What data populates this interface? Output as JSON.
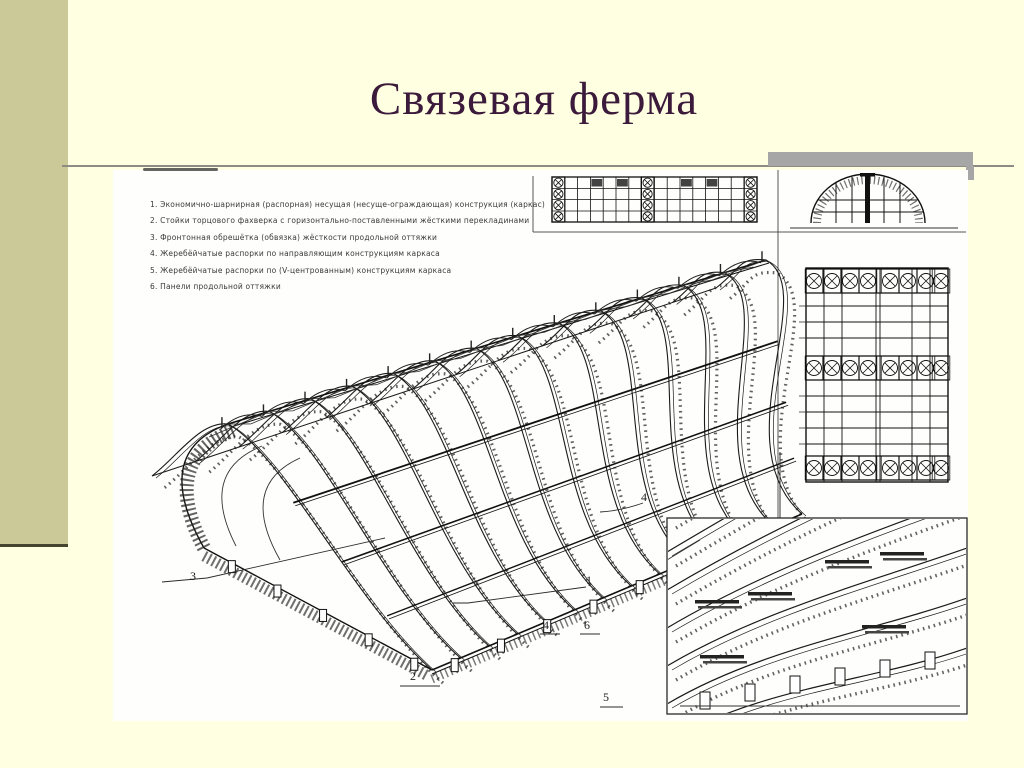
{
  "slide": {
    "title": "Связевая ферма"
  },
  "figure": {
    "legend": {
      "items": [
        "1.  Экономично-шарнирная (распорная) несущая (несуще-ограждающая) конструкция (каркас)",
        "2.  Стойки торцового фахверка с горизонтально-поставленными жёсткими перекладинами",
        "3.  Фронтонная обрешётка (обвязка) жёсткости продольной оттяжки",
        "4.  Жеребёйчатые распорки по направляющим конструкциям каркаса",
        "5.  Жеребёйчатые распорки по (V-центрованным) конструкциям каркаса",
        "6.  Панели продольной оттяжки"
      ]
    },
    "callouts": [
      {
        "label": "3"
      },
      {
        "label": "2"
      },
      {
        "label": "1"
      },
      {
        "label": "4"
      },
      {
        "label": "6"
      },
      {
        "label": "5"
      },
      {
        "label": "4"
      }
    ],
    "views": {
      "main": "изометрия сводчатого каркаса",
      "strip": "план связевой фермы",
      "arch": "торцевая арка",
      "roofplan": "план покрытия со связями",
      "detail": "фрагмент арок"
    }
  },
  "colors": {
    "background": "#FFFFE1",
    "side_band": "#CBC998",
    "band_edge": "#45452F",
    "title": "#3B1A3B",
    "rule": "#8C8C84",
    "shadow_bar": "#A6A6A6",
    "panel": "#FEFEFC",
    "ink": "#1A1A1A"
  }
}
